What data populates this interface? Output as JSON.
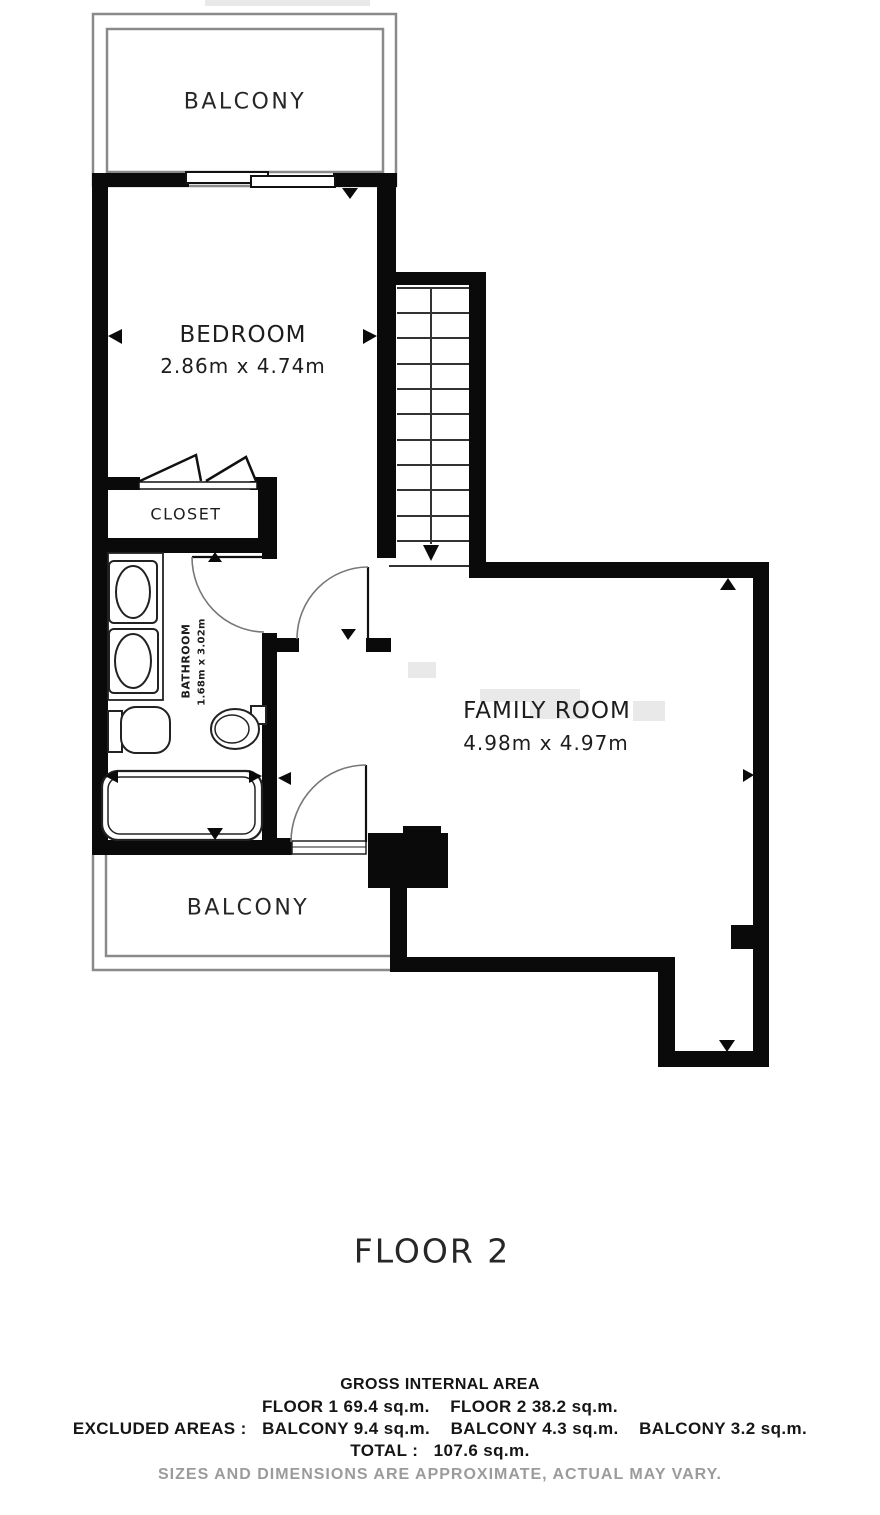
{
  "floor_title": "FLOOR 2",
  "rooms": {
    "balcony_top": {
      "label": "BALCONY"
    },
    "bedroom": {
      "label": "BEDROOM",
      "dims": "2.86m x 4.74m"
    },
    "closet": {
      "label": "CLOSET"
    },
    "bathroom": {
      "label": "BATHROOM",
      "dims": "1.68m x 3.02m"
    },
    "family_room": {
      "label": "FAMILY ROOM",
      "dims": "4.98m x 4.97m"
    },
    "balcony_bottom": {
      "label": "BALCONY"
    }
  },
  "footer": {
    "gross": "GROSS INTERNAL AREA",
    "floors": "FLOOR 1 69.4 sq.m.    FLOOR 2 38.2 sq.m.",
    "excluded": "EXCLUDED AREAS :   BALCONY 9.4 sq.m.    BALCONY 4.3 sq.m.    BALCONY 3.2 sq.m.",
    "total": "TOTAL :   107.6 sq.m.",
    "disclaimer": "SIZES AND DIMENSIONS ARE APPROXIMATE, ACTUAL MAY VARY."
  },
  "colors": {
    "wall": "#0a0a0a",
    "fixture_line": "#222222",
    "balcony_line": "#8a8a8a",
    "arc": "#777777",
    "text": "#1d1d1d",
    "muted": "#9b9b9b"
  }
}
